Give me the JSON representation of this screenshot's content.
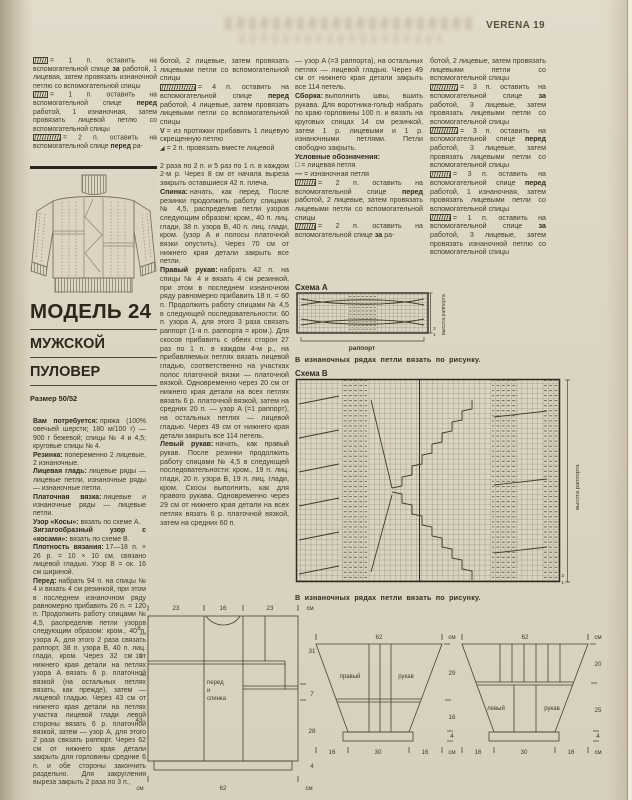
{
  "header": {
    "magazine": "VERENA",
    "page_number": "19"
  },
  "title": {
    "model": "МОДЕЛЬ 24",
    "subtitle1": "МУЖСКОЙ",
    "subtitle2": "ПУЛОВЕР",
    "size": "Размер 50/52"
  },
  "col1": {
    "legend": [
      {
        "text_pre": "= 1 п. оставить на вспомогательной спице ",
        "bold": "за",
        "text_post": " работой, 1 лицевая, затем провязать изнаночной петлю со вспомогательной спицы"
      },
      {
        "text_pre": "= 1 п. оставить на вспомогательной спице ",
        "bold": "перед",
        "text_post": " работой, 1 изнаночная, затем провязать лицевой петлю со вспомогательной спицы"
      },
      {
        "text_pre": "= 2 п. оставить на вспомогательной спице ",
        "bold": "перед",
        "text_post": " ра-"
      }
    ],
    "paragraphs": [
      {
        "lead": "Вам потребуется:",
        "text": "пряжа (100% овечьей шерсти; 180 м/100 г) — 900 г бежевой; спицы № 4 и 4,5; круговые спицы № 4."
      },
      {
        "lead": "Резинка:",
        "text": "попеременно 2 лицевые, 2 изнаночные."
      },
      {
        "lead": "Лицевая гладь:",
        "text": "лицевые ряды — лицевые петли, изнаночные ряды — изнаночные петли."
      },
      {
        "lead": "Платочная вязка:",
        "text": "лицевые и изнаночные ряды — лицевые петли."
      },
      {
        "lead": "Узор «Косы»:",
        "text": "вязать по схеме A."
      },
      {
        "lead": "Зигзагообразный узор с «косами»:",
        "text": "вязать по схеме B."
      },
      {
        "lead": "Плотность вязания:",
        "text": "17—18 п. × 26 р. = 10 × 10 см, связано лицевой гладью. Узор B = ок. 16 см шириной."
      },
      {
        "lead": "Перед:",
        "text": "набрать 94 п. на спицы № 4 и вязать 4 см резинкой, при этом в последнем изнаночном ряду равномерно прибавить 26 п. = 120 п. Продолжить работу спицами № 4,5, распределив петли узоров следующим образом: кром., 40 п. узора A, для этого 2 раза связать раппорт, 38 п. узора B, 40 п. лиц. глади, кром. Через 32 см от нижнего края детали на петлях узора A вязать 6 р. платочной вязкой (на остальных петлях вязать, как прежде), затем — лицевой гладью. Через 43 см от нижнего края детали на петлях участка лицевой глади левой стороны вязать 6 р. платочной вязкой, затем — узор A, для этого 2 раза связать раппорт. Через 62 см от нижнего края детали закрыть для горловины средние 6 п. и обе стороны закончить раздельно. Для закругления выреза закрыть 2 раза по 3 п.,"
      }
    ]
  },
  "col2": {
    "legend_cont": "ботой, 2 лицевые, затем провязать лицевыми петли со вспомогательной спицы",
    "legend": [
      {
        "text_pre": "= 4 п. оставить на вспомогательной спице ",
        "bold": "перед",
        "text_post": " работой, 4 лицевые, затем провязать лицевыми петли со вспомогательной спицы"
      },
      {
        "sym": "V",
        "text": "= из протяжки прибавить 1 лицевую скрещенную петлю"
      },
      {
        "sym": "◢",
        "text": "= 2 п. провязать вместе лицевой"
      }
    ],
    "paragraphs": [
      {
        "lead": "",
        "text": "2 раза по 2 п. и 5 раз по 1 п. в каждом 2-м р. Через 8 см от начала выреза закрыть оставшиеся 42 п. плеча."
      },
      {
        "lead": "Спинка:",
        "text": "начать, как перед. После резинки продолжить работу спицами № 4,5, распределив петли узоров следующим образом: кром., 40 п. лиц. глади, 38 п. узора B, 40 п. лиц. глади, кром. (узор A и полосы платочной вязки опустить). Через 70 см от нижнего края детали закрыть все петли."
      },
      {
        "lead": "Правый рукав:",
        "text": "набрать 42 п. на спицы № 4 и вязать 4 см резинкой, при этом в последнем изнаночном ряду равномерно прибавить 18 п. = 60 п. Продолжить работу спицами № 4,5 в следующей последовательности: 60 п. узора A, для этого 3 раза связать раппорт (1-я п. раппорта = кром.). Для скосов прибавить с обеих сторон 27 раз по 1 п. в каждом 4-м р., на прибавляемых петлях вязать лицевой гладью, соответственно на участках полос платочной вязки — платочной вязкой. Одновременно через 20 см от нижнего края детали на всех петлях вязать 6 р. платочной вязкой, затем на средних 20 п. — узор A (=1 раппорт), на остальных петлях — лицевой гладью. Через 49 см от нижнего края детали закрыть все 114 петель."
      },
      {
        "lead": "Левый рукав:",
        "text": "начать, как правый рукав. После резинки продолжить работу спицами № 4,5 в следующей последовательности: кром., 19 п. лиц. глади, 20 п. узора B, 19 п. лиц. глади, кром. Скосы выполнить, как для правого рукава. Одновременно через 29 см от нижнего края детали на всех петлях вязать 6 р. платочной вязкой, затем на средних 60 п."
      }
    ]
  },
  "col3": {
    "paragraphs": [
      {
        "lead": "",
        "text": "— узор A (=3 раппорта), на остальных петлях — лицевой гладью. Через 49 см от нижнего края детали закрыть все 114 петель."
      },
      {
        "lead": "Сборка:",
        "text": "выполнить швы, вшить рукава. Для воротника-гольф набрать по краю горловины 100 п. и вязать на круговых спицах 14 см резинкой, затем 1 р. лицевыми и 1 р. изнаночными петлями. Петли свободно закрыть."
      }
    ],
    "legend_title": "Условные обозначения:",
    "simple": [
      {
        "sym": "□",
        "text": "= лицевая петля"
      },
      {
        "sym": "—",
        "text": "= изнаночная петля"
      }
    ],
    "legend": [
      {
        "text_pre": "= 2 п. оставить на вспомогательной спице ",
        "bold": "перед",
        "text_post": " работой, 2 лицевые, затем провязать лицевыми петли со вспомогательной спицы"
      },
      {
        "text_pre": "= 2 п. оставить на вспомогательной спице ",
        "bold": "за",
        "text_post": " ра-"
      }
    ]
  },
  "col4": {
    "legend_cont": "ботой, 2 лицевые, затем провязать лицевыми петли со вспомогательной спицы",
    "legend": [
      {
        "text_pre": "= 3 п. оставить на вспомогательной спице ",
        "bold": "за",
        "text_post": " работой, 3 лицевые, затем провязать лицевыми петли со вспомогательной спицы"
      },
      {
        "text_pre": "= 3 п. оставить на вспомогательной спице ",
        "bold": "перед",
        "text_post": " работой, 3 лицевые, затем провязать лицевыми петли со вспомогательной спицы"
      },
      {
        "text_pre": "= 3 п. оставить на вспомогательной спице ",
        "bold": "перед",
        "text_post": " работой, 1 изнаночная, затем провязать лицевыми петли со вспомогательной спицы"
      },
      {
        "text_pre": "= 1 п. оставить на вспомогательной спице ",
        "bold": "за",
        "text_post": " работой, 3 лицевые, затем провязать изнаночной петлю со вспомогательной спицы"
      }
    ]
  },
  "charts": {
    "a": {
      "title": "Схема A",
      "rapport": "раппорт",
      "height_label": "высота раппорта",
      "row3": "3",
      "row1": "1",
      "caption": "В изнаночных рядах петли вязать по рисунку."
    },
    "b": {
      "title": "Схема B",
      "height_label": "высота раппорта",
      "row3": "3",
      "row1": "1",
      "caption": "В изнаночных рядах петли вязать по рисунку."
    }
  },
  "schematics": {
    "body": {
      "label1": "перед",
      "label2": "и",
      "label3": "спинка",
      "top1": "23",
      "top2": "16",
      "top3": "23",
      "unit": "см",
      "left1": "8",
      "left2": "19",
      "left3": "43",
      "right1": "31",
      "right2": "7",
      "right3": "28",
      "right4": "4",
      "bottom": "62"
    },
    "sleeve_right": {
      "label1": "правый",
      "label2": "рукав",
      "top": "62",
      "unit": "см",
      "r1": "29",
      "r2": "16",
      "r3": "4",
      "b1": "16",
      "b2": "30",
      "b3": "16"
    },
    "sleeve_left": {
      "label1": "левый",
      "label2": "рукав",
      "top": "62",
      "unit": "см",
      "r1": "20",
      "r2": "25",
      "r3": "4",
      "b1": "16",
      "b2": "30",
      "b3": "16"
    }
  }
}
